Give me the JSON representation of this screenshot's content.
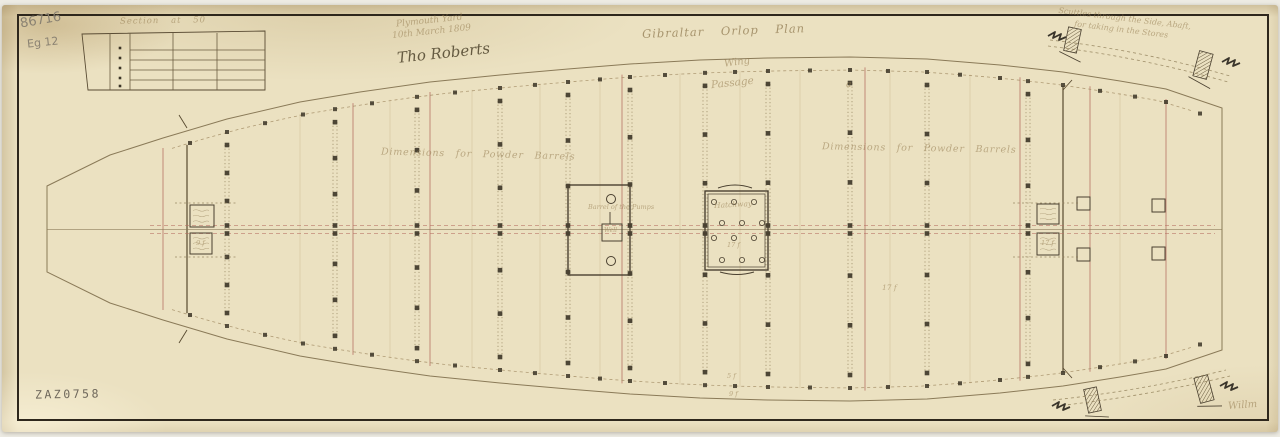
{
  "texts": {
    "pencil_code": "86716",
    "pencil_code2": "Eg 12",
    "inset_caption": "Section at 50",
    "yard_line1": "Plymouth Yard",
    "yard_line2": "10th March 1809",
    "signature": "Tho Roberts",
    "title": "Gibraltar Orlop Plan",
    "wing": "Wing",
    "passage": "Passage",
    "dims_left": "Dimensions for Powder Barrels",
    "dims_right": "Dimensions for Powder Barrels",
    "pump_note": "Barrel of the Pumps",
    "well": "Well",
    "hatch_label": "Hatchway",
    "hatch_dim": "17 f",
    "mid_dim": "17 f",
    "keel_dim1": "5 f",
    "keel_dim2": "9 f",
    "bow_box_dim": "9 f",
    "stern_box_dim": "17 f",
    "small_a": "a",
    "tr_note1": "Scuttles through the Side, Abaft,",
    "tr_note2": "for taking in the Stores",
    "br_signature": "Willm",
    "stamp": "ZAZ0758"
  },
  "colors": {
    "paper": "#ebe1c1",
    "border": "#2e271c",
    "ink": "#6b5d41",
    "outline": "#8a7a58",
    "red": "#b66f62",
    "faint": "#c9b88e",
    "dark": "#3c3527",
    "script": "#9c8a64"
  },
  "drawing": {
    "hull_top": [
      [
        47,
        186
      ],
      [
        110,
        155
      ],
      [
        163,
        138
      ],
      [
        227,
        119
      ],
      [
        300,
        102
      ],
      [
        360,
        92
      ],
      [
        430,
        82
      ],
      [
        500,
        75
      ],
      [
        568,
        69
      ],
      [
        630,
        64
      ],
      [
        700,
        60
      ],
      [
        768,
        58
      ],
      [
        850,
        57
      ],
      [
        927,
        59
      ],
      [
        1000,
        65
      ],
      [
        1063,
        72
      ],
      [
        1120,
        81
      ],
      [
        1166,
        89
      ],
      [
        1222,
        108
      ]
    ],
    "mirror_sum": 458,
    "bow_x": 47,
    "stern_x": 1222,
    "center_solid_y": 229.5,
    "center_dash_y": [
      225.5,
      233.5
    ],
    "columns": [
      227,
      335,
      417,
      500,
      568,
      630,
      705,
      768,
      850,
      927,
      1028
    ],
    "red_lines": [
      163,
      353,
      430,
      622,
      865,
      1020,
      1090,
      1166
    ],
    "faint_lines": [
      300,
      390,
      472,
      540,
      600,
      680,
      740,
      800,
      890,
      970,
      1120
    ],
    "dark_lines": [
      187,
      1063
    ],
    "edge_squares": [
      190,
      227,
      265,
      303,
      335,
      372,
      417,
      455,
      500,
      535,
      568,
      600,
      630,
      665,
      705,
      735,
      768,
      810,
      850,
      888,
      927,
      960,
      1000,
      1028,
      1063,
      1100,
      1135,
      1166,
      1200
    ],
    "ticks": [
      [
        187,
        128,
        179,
        115
      ],
      [
        187,
        330,
        179,
        343
      ],
      [
        1063,
        90,
        1072,
        80
      ],
      [
        1063,
        368,
        1072,
        378
      ]
    ],
    "well_rect": [
      568,
      185,
      62,
      90
    ],
    "well_circles": [
      [
        611,
        199
      ],
      [
        611,
        261
      ]
    ],
    "well_inner": [
      602,
      224,
      20,
      17
    ],
    "hatch_rect": [
      705,
      191,
      63,
      79
    ],
    "hatch_inner": [
      708,
      194,
      57,
      73
    ],
    "hatch_circle_rows": [
      {
        "y": 202,
        "xs": [
          714,
          734,
          754
        ]
      },
      {
        "y": 223,
        "xs": [
          722,
          742,
          762
        ]
      },
      {
        "y": 238,
        "xs": [
          714,
          734,
          754
        ]
      },
      {
        "y": 260,
        "xs": [
          722,
          742,
          762
        ]
      }
    ],
    "hatch_arcs": [
      "M718,188 Q735,182 752,188",
      "M720,272 Q737,277 754,272"
    ],
    "note_boxes": [
      [
        190,
        205,
        24,
        22
      ],
      [
        190,
        233,
        22,
        21
      ],
      [
        1037,
        204,
        22,
        20
      ],
      [
        1037,
        233,
        22,
        22
      ]
    ],
    "plain_squares": [
      [
        1077,
        197,
        13,
        13
      ],
      [
        1077,
        248,
        13,
        13
      ],
      [
        1152,
        199,
        13,
        13
      ],
      [
        1152,
        247,
        13,
        13
      ]
    ],
    "dashed_h": [
      [
        175,
        203,
        62
      ],
      [
        175,
        257,
        62
      ],
      [
        1013,
        203,
        66
      ],
      [
        1013,
        257,
        66
      ]
    ],
    "inset": {
      "outline": [
        [
          82,
          34
        ],
        [
          265,
          31
        ],
        [
          265,
          90
        ],
        [
          88,
          90
        ]
      ],
      "verticals": [
        110,
        130,
        173,
        217
      ],
      "h_lines": [
        50,
        60,
        70,
        80
      ],
      "h_span": [
        130,
        265
      ],
      "dots_x": 120,
      "dots_y": [
        48,
        58,
        68,
        78,
        86
      ]
    },
    "scuttles": [
      [
        1066,
        28,
        13,
        24,
        12
      ],
      [
        1196,
        52,
        14,
        26,
        15
      ],
      [
        1086,
        388,
        13,
        24,
        -12
      ],
      [
        1197,
        376,
        14,
        26,
        -15
      ]
    ],
    "dash_curves": [
      "M1050,40 Q1140,50 1230,76",
      "M1048,46 Q1140,57 1228,82",
      "M1053,400 Q1140,391 1226,370",
      "M1056,406 Q1142,397 1230,376"
    ],
    "squiggles": [
      [
        1048,
        36
      ],
      [
        1222,
        62
      ],
      [
        1052,
        406
      ],
      [
        1220,
        386
      ]
    ]
  }
}
